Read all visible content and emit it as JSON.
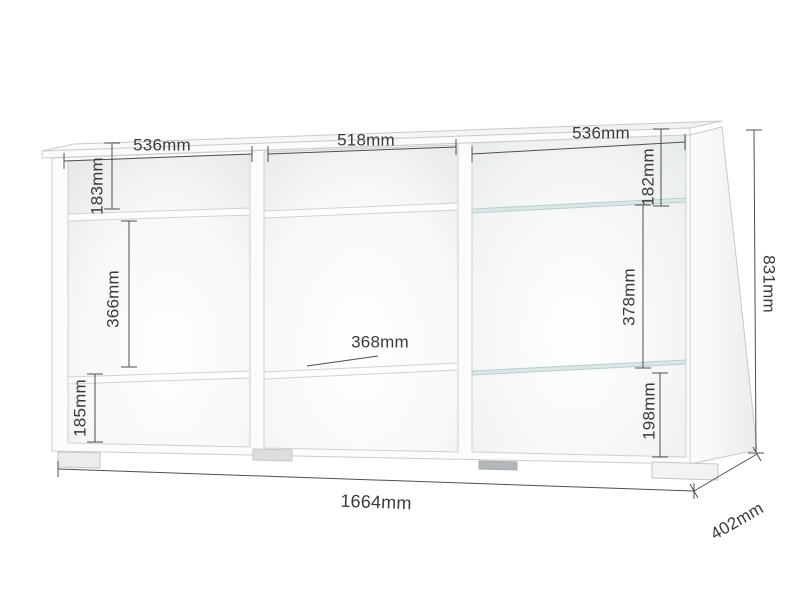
{
  "diagram": {
    "type": "furniture-dimension-drawing",
    "unit": "mm",
    "sections": {
      "left": {
        "width": "536mm",
        "top_height": "183mm",
        "middle_height": "366mm",
        "bottom_height": "185mm"
      },
      "middle": {
        "width": "518mm",
        "shelf_dimension": "368mm"
      },
      "right": {
        "width": "536mm",
        "top_height": "182mm",
        "middle_height": "378mm",
        "bottom_height": "198mm"
      }
    },
    "overall": {
      "width": "1664mm",
      "depth": "402mm",
      "height": "831mm"
    }
  },
  "colors": {
    "background": "#ffffff",
    "dimension_line": "#4f4f4f",
    "label_text": "#3a3a3a",
    "panel_edge": "#c9c9c9",
    "glass_shelf": "#d9e7e6"
  }
}
